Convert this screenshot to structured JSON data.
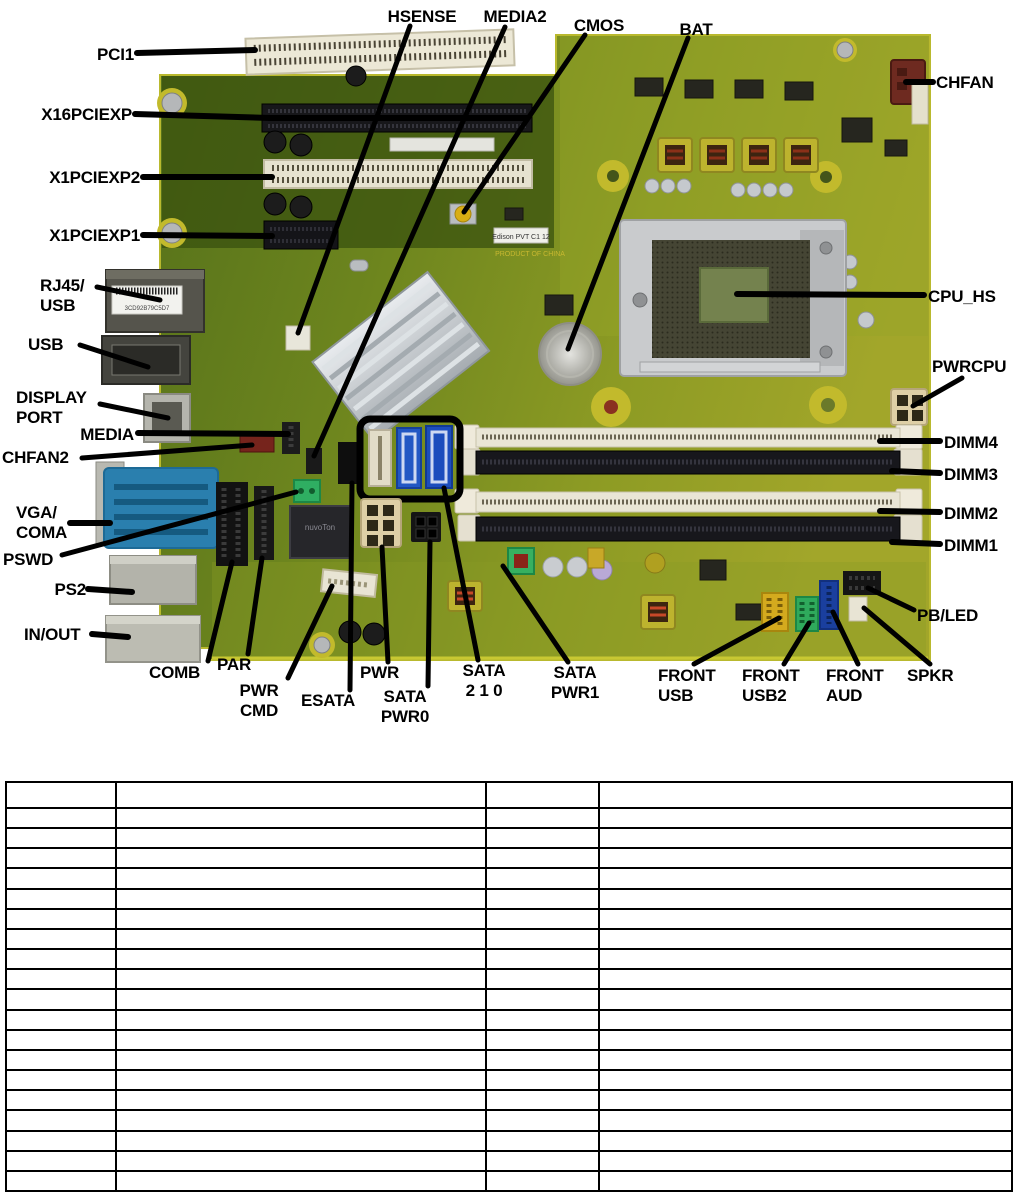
{
  "page": {
    "background": "#ffffff"
  },
  "board_photo": {
    "pcb_color": "#6d851e",
    "highlight_box_color": "#000000",
    "barcode_text": "3CD92B79C5D7",
    "chip_text": "nuvoTon",
    "sticker_text": "Edison PVT C1 12",
    "silkscreen_text": "PRODUCT OF CHINA"
  },
  "callouts": {
    "hsense": "HSENSE",
    "media2": "MEDIA2",
    "cmos": "CMOS",
    "bat": "BAT",
    "pci1": "PCI1",
    "x16pciexp": "X16PCIEXP",
    "x1pciexp2": "X1PCIEXP2",
    "x1pciexp1": "X1PCIEXP1",
    "rj45_usb": "RJ45/\nUSB",
    "usb": "USB",
    "display_port": "DISPLAY\nPORT",
    "media": "MEDIA",
    "chfan2": "CHFAN2",
    "vga_coma": "VGA/\nCOMA",
    "pswd": "PSWD",
    "ps2": "PS2",
    "in_out": "IN/OUT",
    "chfan": "CHFAN",
    "cpu_hs": "CPU_HS",
    "pwrcpu": "PWRCPU",
    "dimm4": "DIMM4",
    "dimm3": "DIMM3",
    "dimm2": "DIMM2",
    "dimm1": "DIMM1",
    "pb_led": "PB/LED",
    "spkr": "SPKR",
    "comb": "COMB",
    "par": "PAR",
    "pwr_cmd": "PWR\nCMD",
    "esata": "ESATA",
    "pwr": "PWR",
    "sata_pwr0": "SATA\nPWR0",
    "sata_210": "SATA\n2 1 0",
    "sata_pwr1": "SATA\nPWR1",
    "front_usb": "FRONT\nUSB",
    "front_usb2": "FRONT\nUSB2",
    "front_aud": "FRONT\nAUD"
  },
  "table": {
    "row_count": 20,
    "column_count": 4,
    "column_widths_px": [
      110,
      370,
      113,
      413
    ],
    "header_row_height_px": 26,
    "cells_empty": true
  }
}
